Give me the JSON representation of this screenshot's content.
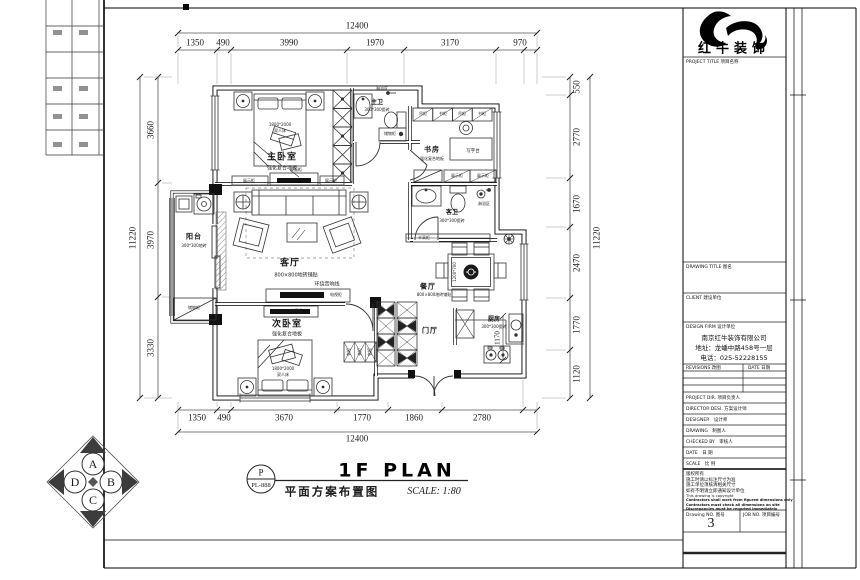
{
  "titlebar": {
    "stamp_letter": "P",
    "stamp_code": "PL-888",
    "title_en": "1F PLAN",
    "title_cn": "平面方案布置图",
    "scale": "SCALE: 1:80"
  },
  "compass": {
    "a": "A",
    "b": "B",
    "c": "C",
    "d": "D"
  },
  "dims": {
    "top_total": "12400",
    "top": [
      "1350",
      "490",
      "3990",
      "1970",
      "3170",
      "970"
    ],
    "bottom_total": "12400",
    "bottom": [
      "1350",
      "490",
      "3670",
      "1770",
      "1860",
      "2780"
    ],
    "left_total": "11220",
    "left": [
      "3660",
      "3970",
      "3330"
    ],
    "right_total": "11220",
    "right": [
      "550",
      "2770",
      "1670",
      "2470",
      "1770",
      "1120"
    ],
    "kitchen": "1170"
  },
  "rooms": {
    "master": {
      "name": "主卧室",
      "floor": "强化复合地板",
      "bed_size": "1800*2000",
      "bed": "双人床"
    },
    "mbath": {
      "name": "主卫",
      "floor": "300*300瓷砖",
      "shower": "淋浴区",
      "cab": "储物柜"
    },
    "study": {
      "name": "书房",
      "floor": "强化复合地板",
      "desk": "写字台",
      "cab1": "吊柜",
      "cab2": "书柜",
      "disp": "展示柜"
    },
    "gbath": {
      "name": "客卫",
      "floor": "300*300瓷砖",
      "shower": "淋浴区"
    },
    "living": {
      "name": "客厅",
      "floor": "800×800地砖铺贴",
      "audio": "环绕音响线",
      "tv": "电视柜",
      "disp": "展示柜",
      "dbl": "双面柜"
    },
    "balcony": {
      "name": "阳台",
      "floor": "300*300地砖",
      "cab": "储物柜"
    },
    "bed2": {
      "name": "次卧室",
      "floor": "强化复合地板",
      "bed_size": "1800*2000",
      "bed": "双人床",
      "tv": "电视柜",
      "ward": "衣柜"
    },
    "dining": {
      "name": "餐厅",
      "floor": "800×800地砖铺贴",
      "table": "1200*700",
      "half": "半高柜"
    },
    "foyer": {
      "name": "门厅"
    },
    "kitchen": {
      "name": "厨房",
      "floor": "300*300瓷砖"
    }
  },
  "title_block": {
    "brand": "红牛装饰",
    "project_title": "PROJECT TITLE 项目名称",
    "drawing_title": "DRAWING TITLE 图名",
    "client": "CLIENT 建设单位",
    "design_firm": "DESIGN FIRM 设计单位",
    "firm_name": "南京红牛装饰有限公司",
    "firm_address": "地址：龙蟠中路458号一层",
    "firm_phone": "电话：025-52228155",
    "revisions": "REVISIONS 改图",
    "date_col": "DATE 日期",
    "row_labels": [
      "PROJECT DIR. 项目负责人",
      "DIRECTOR DESI. 方案设计师",
      "DESIGNER　设计师",
      "DRAWING　制图人",
      "CHECKED BY　审核人",
      "DATE　日  期",
      "SCALE　比  例"
    ],
    "notes": [
      "版权所有",
      "施工时请以标注尺寸为准",
      "施工单位须核清相关尺寸",
      "如有不明请立即通知设计单位",
      "This drawing is copyright",
      "Contractors shall work from figured dimensions only",
      "Contractors must check all dimensions on site",
      "Discrepancies must be reported immediately"
    ],
    "drawing_no_label": "Drawing NO. 图号",
    "drawing_no": "3",
    "job_no_label": "JOB NO. 项目编号"
  }
}
